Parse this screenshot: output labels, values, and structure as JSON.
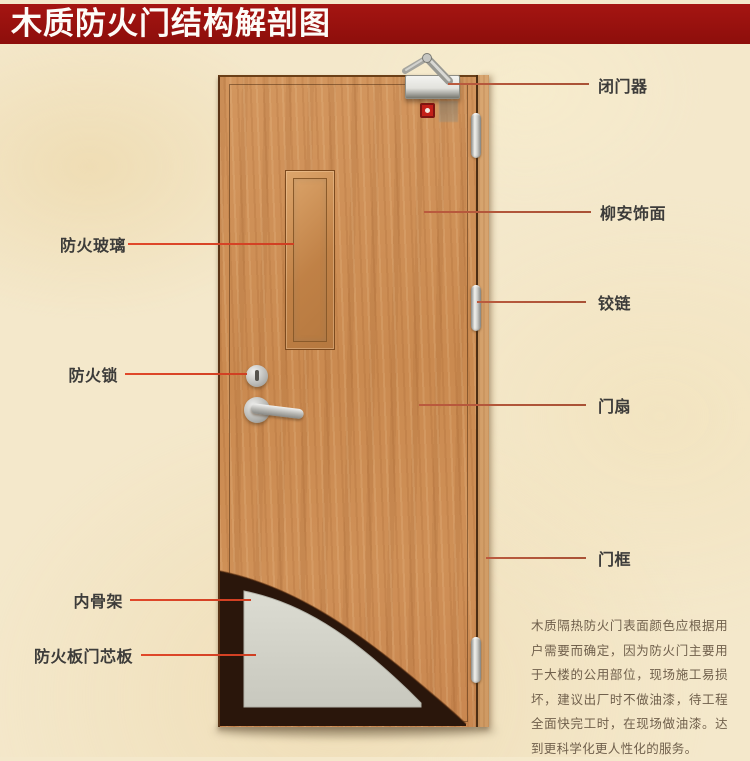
{
  "title": "木质防火门结构解剖图",
  "left_labels": [
    {
      "text": "防火玻璃"
    },
    {
      "text": "防火锁"
    },
    {
      "text": "内骨架"
    },
    {
      "text": "防火板门芯板"
    }
  ],
  "right_labels": [
    {
      "text": "闭门器"
    },
    {
      "text": "柳安饰面"
    },
    {
      "text": "铰链"
    },
    {
      "text": "门扇"
    },
    {
      "text": "门框"
    }
  ],
  "description": "木质隔热防火门表面颜色应根据用户需要而确定，因为防火门主要用于大楼的公用部位，现场施工易损坏，建议出厂时不做油漆，待工程全面快完工时，在现场做油漆。达到更科学化更人性化的服务。",
  "colors": {
    "banner": "#9b100e",
    "door_wood": "#cc8f57",
    "left_line": "#e1482a",
    "right_line": "#b45a42",
    "core_panel": "#d2d2c8",
    "inner_frame": "#2a160b"
  }
}
